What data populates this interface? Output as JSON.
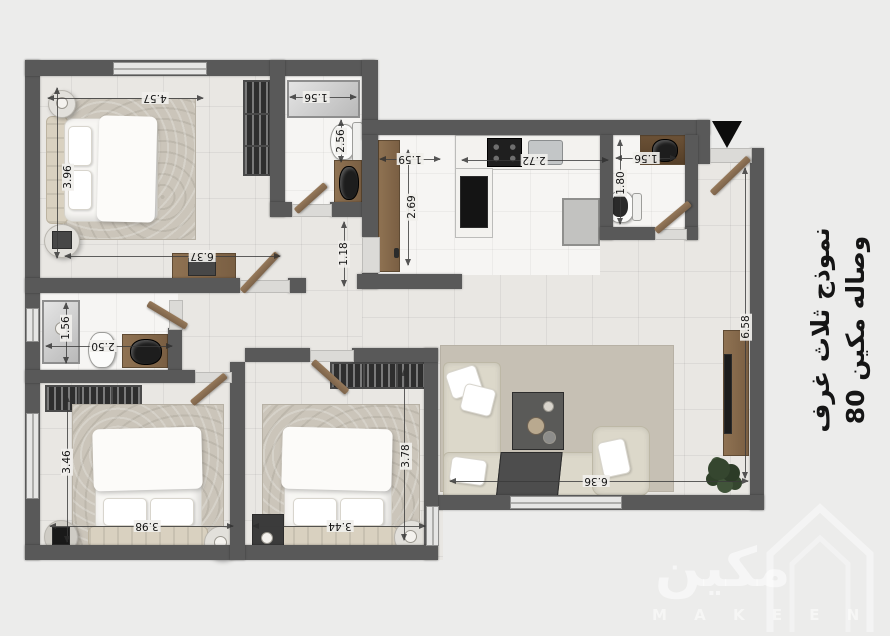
{
  "plan": {
    "entry_marker": "entrance-arrow",
    "dims": {
      "bedroom1_width": "4.57",
      "bedroom1_height": "3.96",
      "hall_length": "6.37",
      "bath1_shower_width": "1.56",
      "bath1_depth": "2.56",
      "corridor_width": "1.18",
      "kitchen_counter": "1.59",
      "kitchen_depth": "2.69",
      "kitchen_width": "2.72",
      "wc_width": "1.56",
      "wc_depth": "1.80",
      "bath2_height": "1.56",
      "bath2_width": "2.50",
      "bedroom2_height": "3.46",
      "bedroom2_width": "3.98",
      "bedroom3_height": "3.78",
      "bedroom3_width": "3.44",
      "living_height": "6.58",
      "living_width": "6.36"
    },
    "side_text": {
      "line1": "نموذج ثلاث غرف",
      "line2": "وصاله مكين 80"
    },
    "watermark": {
      "arabic": "مكين",
      "latin": "M A K E E N"
    },
    "colors": {
      "wall": "#595959",
      "floor_tile": "#e9e7e3",
      "floor_marble": "#f6f5f3",
      "wood": "#8a6f52",
      "page_bg": "#ececeb"
    }
  }
}
